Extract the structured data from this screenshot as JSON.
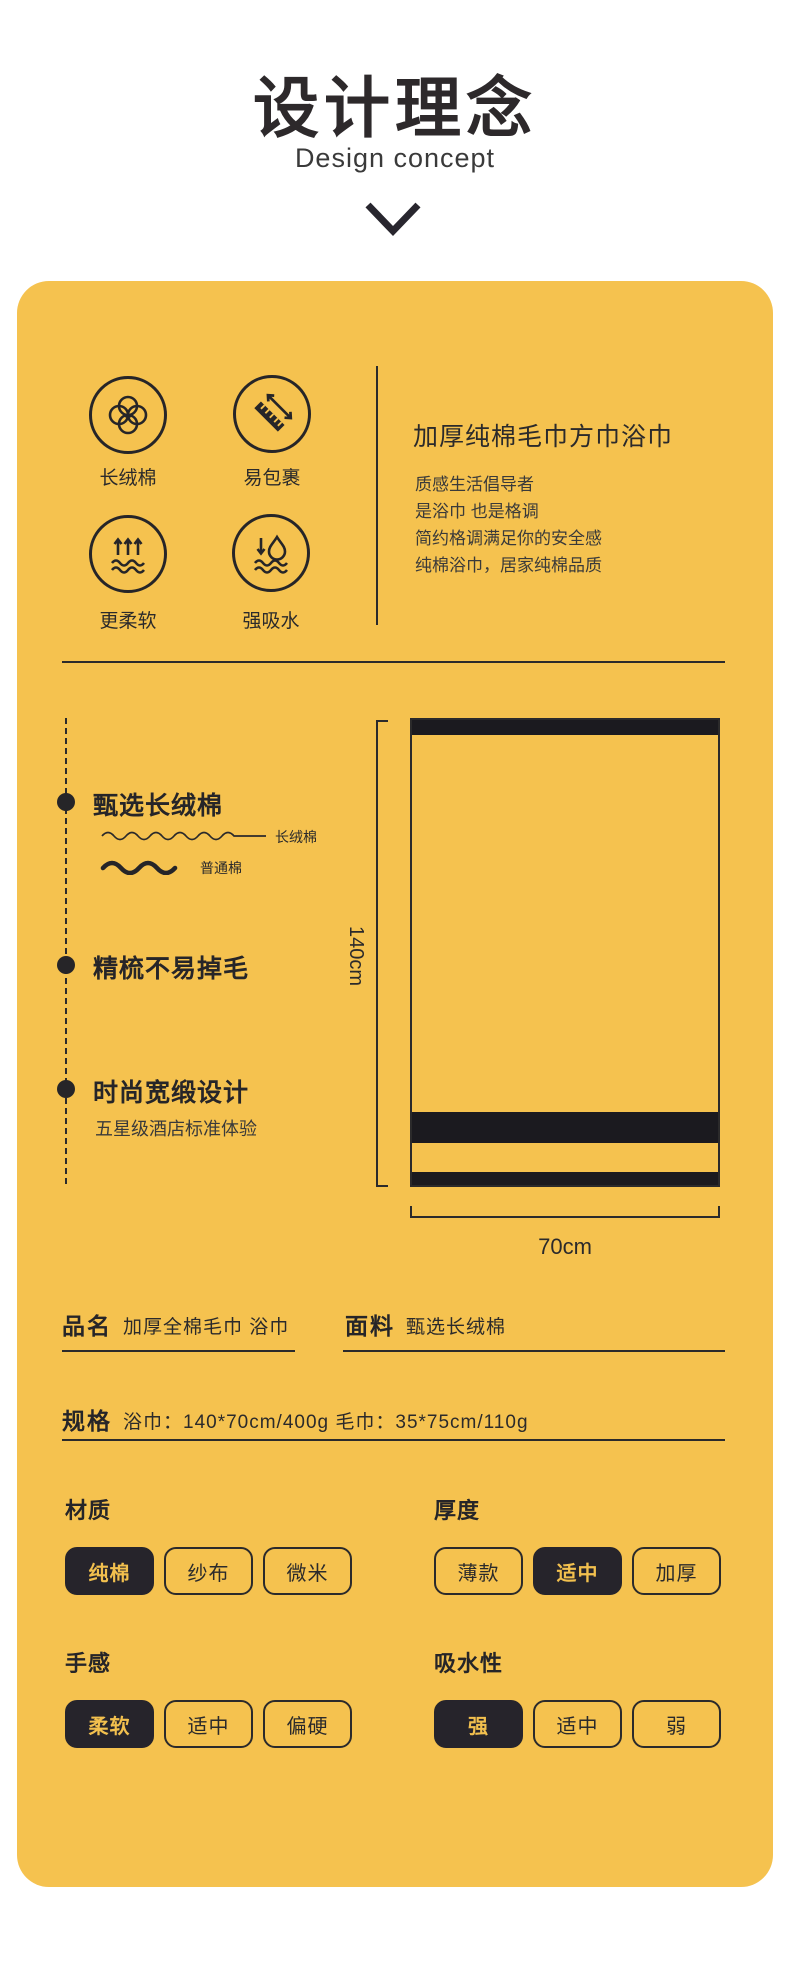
{
  "page": {
    "title": "设计理念",
    "subtitle": "Design concept"
  },
  "icons": {
    "items": [
      {
        "name": "cotton",
        "label": "长绒棉"
      },
      {
        "name": "wrap-ruler",
        "label": "易包裹"
      },
      {
        "name": "softer",
        "label": "更柔软"
      },
      {
        "name": "absorbent",
        "label": "强吸水"
      }
    ]
  },
  "intro": {
    "heading": "加厚纯棉毛巾方巾浴巾",
    "lines": [
      "质感生活倡导者",
      "是浴巾 也是格调",
      "简约格调满足你的安全感",
      "纯棉浴巾，居家纯棉品质"
    ]
  },
  "points": [
    {
      "title": "甄选长绒棉",
      "wave_labels": [
        "长绒棉",
        "普通棉"
      ]
    },
    {
      "title": "精梳不易掉毛"
    },
    {
      "title": "时尚宽缎设计",
      "subtitle": "五星级酒店标准体验"
    }
  ],
  "diagram": {
    "height_label": "140cm",
    "width_label": "70cm"
  },
  "specs": [
    {
      "label": "品名",
      "value": "加厚全棉毛巾 浴巾"
    },
    {
      "label": "面料",
      "value": "甄选长绒棉"
    },
    {
      "label": "规格",
      "value": "浴巾：140*70cm/400g 毛巾：35*75cm/110g"
    }
  ],
  "attributes": [
    {
      "label": "材质",
      "options": [
        "纯棉",
        "纱布",
        "微米"
      ],
      "selected": 0
    },
    {
      "label": "厚度",
      "options": [
        "薄款",
        "适中",
        "加厚"
      ],
      "selected": 1
    },
    {
      "label": "手感",
      "options": [
        "柔软",
        "适中",
        "偏硬"
      ],
      "selected": 0
    },
    {
      "label": "吸水性",
      "options": [
        "强",
        "适中",
        "弱"
      ],
      "selected": 0
    }
  ],
  "colors": {
    "card_bg": "#f5c24f",
    "ink": "#2b2a2b",
    "chip_dark": "#26242b",
    "chip_dark_text": "#f2c04e"
  }
}
